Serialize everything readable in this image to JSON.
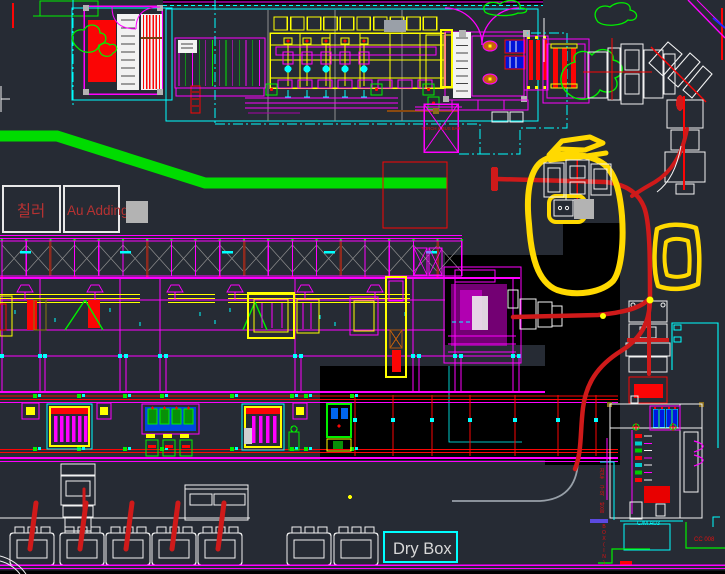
{
  "labels": {
    "chiller": "칠러",
    "au_adding": "Au Adding",
    "dry_box": "Dry Box",
    "torch_bus_bar": "TORCH & BUS BAR",
    "unit_code": "C/M A03",
    "circuit_code": "CC 008",
    "box_in": "BOX(IN)",
    "zone_note_vertical": "저류 구의 방음"
  },
  "colors": {
    "bg": "#262b34",
    "black": "#000000",
    "magenta": "#ff00ff",
    "cyan": "#00ffff",
    "yellow": "#ffff00",
    "red": "#fb0505",
    "green": "#00f000",
    "blue": "#2424ff",
    "indigo": "#5b4ae0",
    "white": "#f2f2f2",
    "linegray": "#8f8f8f",
    "grayfill": "#b3b3b3",
    "marker": "#ffd900",
    "route": "#cf1a1a",
    "labelred": "#b63232",
    "agv": "#00dc00",
    "darkred": "#8e2a1e"
  }
}
